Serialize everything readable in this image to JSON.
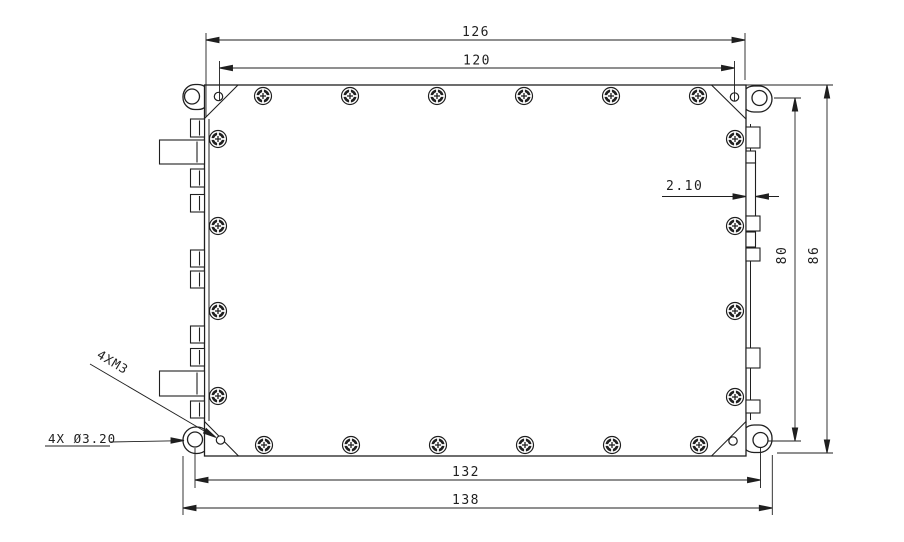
{
  "drawing": {
    "background": "#ffffff",
    "line_color": "#1f1f1f",
    "dimensions": {
      "top_outer": "126",
      "top_inner": "120",
      "bottom_inner": "132",
      "bottom_outer": "138",
      "right_inner": "80",
      "right_outer": "86",
      "wall_thickness": "2.10"
    },
    "labels": {
      "thread_callout": "4XM3",
      "hole_callout": "4X Ø3.20"
    }
  }
}
